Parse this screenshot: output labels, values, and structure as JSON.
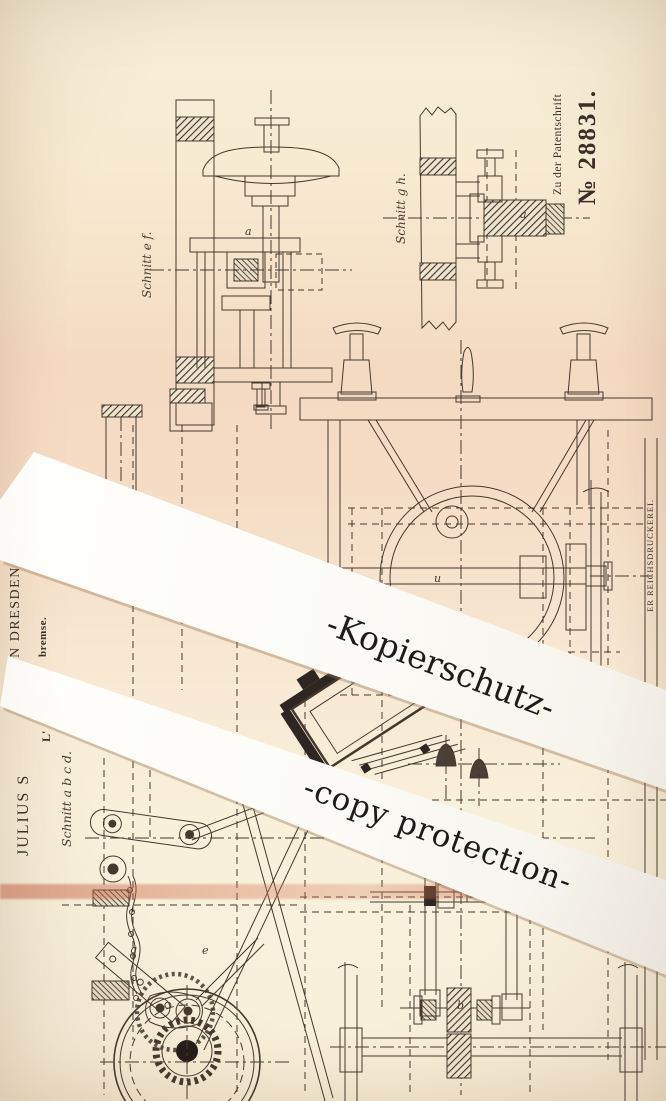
{
  "header": {
    "series_label": "Zu der Patentschrift",
    "patent_number": "№ 28831."
  },
  "patent": {
    "applicant_fragment": "JULIUS S",
    "applicant_location_fragment": "IN DRESDEN.",
    "title_initial_fragment": "L'",
    "title_end_fragment": "bremse.",
    "printer_fragment_upper": "ER REICHSDRUCKEREI.",
    "printer_fragment_lower": "PH"
  },
  "figure_labels": {
    "section_ef": "Schnitt e f.",
    "section_gh": "Schnitt g h.",
    "section_abcd": "Schnitt a b c d."
  },
  "figure_letters": [
    {
      "t": "a",
      "x": 245,
      "y": 225
    },
    {
      "t": "a",
      "x": 520,
      "y": 208
    },
    {
      "t": "u",
      "x": 434,
      "y": 572
    },
    {
      "t": "g",
      "x": 130,
      "y": 943
    },
    {
      "t": "e",
      "x": 202,
      "y": 944
    },
    {
      "t": "b",
      "x": 457,
      "y": 999
    }
  ],
  "watermark": {
    "line1": "-Kopierschutz-",
    "line2": "-copy protection-"
  },
  "colors": {
    "paper_cream": "#f8efd8",
    "paper_pink": "#f5dac2",
    "strip_white": "#fcfbf7",
    "ink": "#45392e",
    "stripe_salmon": "#c75c3e"
  }
}
